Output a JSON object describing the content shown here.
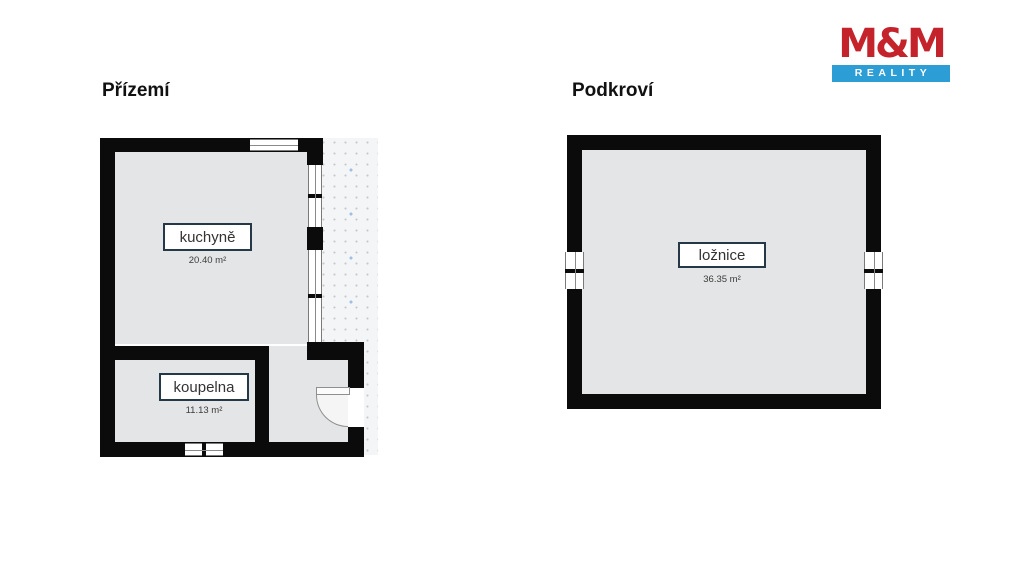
{
  "plans": [
    {
      "title": "Přízemí",
      "rooms": [
        {
          "name": "kuchyně",
          "area": "20.40 m²"
        },
        {
          "name": "koupelna",
          "area": "11.13 m²"
        }
      ]
    },
    {
      "title": "Podkroví",
      "rooms": [
        {
          "name": "ložnice",
          "area": "36.35 m²"
        }
      ]
    }
  ],
  "logo": {
    "name": "M&M",
    "subtitle": "REALITY"
  },
  "colors": {
    "wall": "#0b0b0b",
    "floor": "#e4e5e6",
    "label_border": "#243848",
    "logo_red": "#c4232b",
    "logo_blue": "#2d9dd6",
    "terrace_dot_blue": "#9fc0e2",
    "terrace_dot_gray": "#c5c8cc"
  }
}
